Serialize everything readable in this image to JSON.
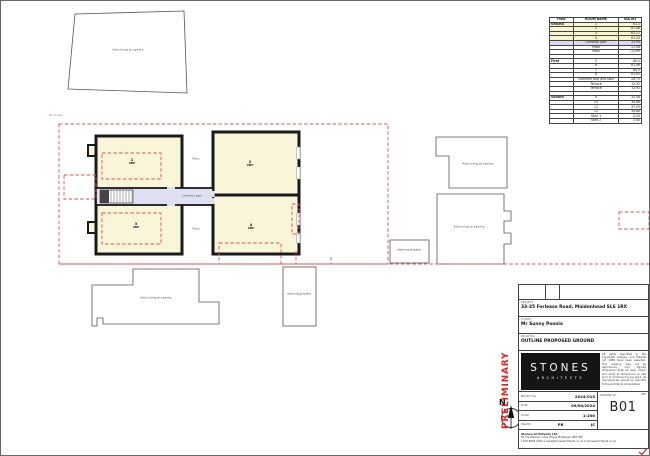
{
  "area_schedule": {
    "headers": [
      "Floor",
      "ROOM NAME",
      "GIA m2"
    ],
    "rows": [
      {
        "floor": "Ground",
        "room": "1",
        "area": "61.1",
        "hl": "ground"
      },
      {
        "floor": "",
        "room": "2",
        "area": "67.06",
        "hl": "ground"
      },
      {
        "floor": "",
        "room": "3",
        "area": "61.17",
        "hl": "ground"
      },
      {
        "floor": "",
        "room": "4",
        "area": "67.03",
        "hl": "ground"
      },
      {
        "floor": "",
        "room": "Common part",
        "area": "31.90",
        "hl": "common"
      },
      {
        "floor": "",
        "room": "Patio",
        "area": "22.08",
        "hl": "none"
      },
      {
        "floor": "",
        "room": "Patio",
        "area": "22.69",
        "hl": "none"
      },
      {
        "floor": "",
        "room": "",
        "area": "",
        "hl": "none"
      },
      {
        "floor": "First",
        "room": "5",
        "area": "60.2",
        "hl": "none"
      },
      {
        "floor": "",
        "room": "6",
        "area": "61.46",
        "hl": "none"
      },
      {
        "floor": "",
        "room": "7",
        "area": "60.2",
        "hl": "none"
      },
      {
        "floor": "",
        "room": "8",
        "area": "61.92",
        "hl": "none"
      },
      {
        "floor": "",
        "room": "Common part and stair",
        "area": "28.75",
        "hl": "none"
      },
      {
        "floor": "",
        "room": "Terrace",
        "area": "12.92",
        "hl": "none"
      },
      {
        "floor": "",
        "room": "Terrace",
        "area": "12.92",
        "hl": "none"
      },
      {
        "floor": "",
        "room": "",
        "area": "",
        "hl": "none"
      },
      {
        "floor": "Second",
        "room": "9",
        "area": "33.38",
        "hl": "none"
      },
      {
        "floor": "",
        "room": "10",
        "area": "34.88",
        "hl": "none"
      },
      {
        "floor": "",
        "room": "11",
        "area": "37.29",
        "hl": "none"
      },
      {
        "floor": "",
        "room": "12",
        "area": "34.88",
        "hl": "none"
      },
      {
        "floor": "",
        "room": "Stair 1",
        "area": "2.04",
        "hl": "none"
      },
      {
        "floor": "",
        "room": "Stair 2",
        "area": "1.40",
        "hl": "none"
      }
    ]
  },
  "plan": {
    "boundary_label": "Boundary",
    "adjoining_label": "Adjoining property",
    "common_part_label": "Common part",
    "patio_label": "Patio",
    "rooms": [
      {
        "number": "1",
        "type": "2BP"
      },
      {
        "number": "2",
        "type": "2BP"
      },
      {
        "number": "3",
        "type": "2BP"
      },
      {
        "number": "4",
        "type": "2BP"
      }
    ]
  },
  "north": {
    "label": "N"
  },
  "titleblock": {
    "project_label": "PROJECT",
    "project": "33-35 Forlease Road, Maidenhead SL6 1RX",
    "client_label": "CLIENT",
    "client": "Mr Sunny Poonia",
    "drawing_label": "DRAWING",
    "drawing": "OUTLINE PROPOSED GROUND",
    "preliminary": "PRELIMINARY",
    "logo_line1": "STONES",
    "logo_line2": "ARCHITECTS",
    "disclaimer": "All rights described in the Copyright, Designs and Patents Act 1988 have been asserted. This drawing may not be reproduced, only figured dimensions shall be used. Check and verify all dimensions on site prior to commencing any work. All discrepancies should be reported to the Architects immediately.",
    "fields": {
      "project_no_label": "PROJECT No",
      "project_no": "2024-015",
      "date_label": "DATE",
      "date": "09/04/2024",
      "scale_label": "SCALE",
      "scale": "1:200",
      "drawn_label": "DRAWN",
      "drawn": "PR",
      "checked": "JC",
      "drawing_no_label": "DRAWING No",
      "rev_label": "REV",
      "rev": "B01"
    },
    "footer": {
      "name": "Stones Architects Ltd",
      "address": "50 Coldharbour Lane Hayes Middlesex UB3 3EP",
      "contact": "t 020 8848 1000   e mail@stonesarchitects.co.uk   w stonesarchitects.co.uk"
    }
  },
  "colors": {
    "room_fill": "#f9f5d8",
    "common_fill": "#dfe1f3",
    "wall": "#1a1a1a",
    "boundary_red": "#e05252",
    "preliminary_red": "#e5231b",
    "logo_black": "#151515"
  }
}
